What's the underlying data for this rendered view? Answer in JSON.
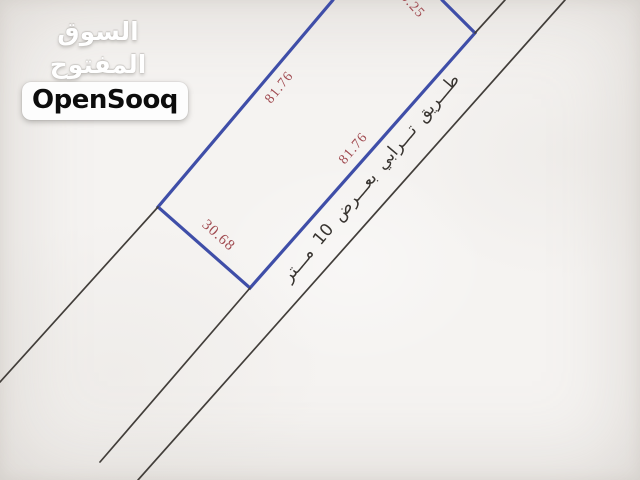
{
  "watermark": {
    "logo_arabic": "السوق المفتوح",
    "logo_latin": "OpenSooq"
  },
  "plot_diagram": {
    "dimension_labels": {
      "top_partial": "0.25",
      "left_side": "81.76",
      "right_side": "81.76",
      "bottom_side": "30.68"
    },
    "road_label": "طـــريق تـــرابي بعـــرض 10 مـــتر"
  },
  "colors": {
    "background": "#f5f3f1",
    "parcel_line": "#3f4ea8",
    "road_line": "#423e3a",
    "dimension_text": "#a04a50",
    "road_text": "#383430"
  }
}
